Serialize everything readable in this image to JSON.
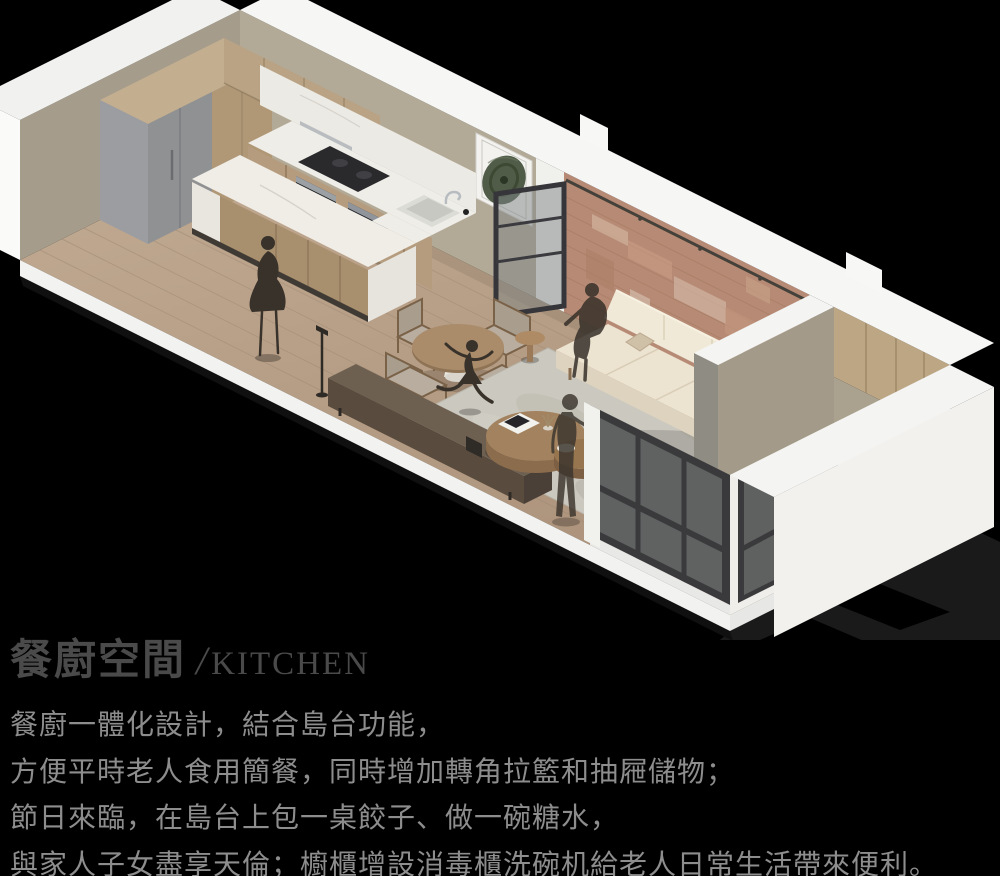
{
  "page": {
    "background_color": "#000000"
  },
  "header": {
    "title_zh": "餐廚空間",
    "title_divider": "/",
    "title_en": "KITCHEN"
  },
  "body": {
    "lines": [
      "餐廚一體化設計，結合島台功能，",
      "方便平時老人食用簡餐，同時增加轉角拉籃和抽屜儲物；",
      "節日來臨，在島台上包一桌餃子、做一碗糖水，",
      "與家人子女盡享天倫；櫥櫃增設消毒櫃洗碗机給老人日常生活帶來便利。"
    ]
  },
  "palette": {
    "background": "#000000",
    "title_text": "#4a4a4a",
    "body_text": "#8d8d8d",
    "white_structure": "#f5f5f3",
    "wall_greige": "#b2a996",
    "wall_side": "#a59c8b",
    "brick_wall": "#b68a74",
    "wood_cabinet": "#b9a384",
    "marble_counter": "#efede7",
    "wood_floor": "#b49c86",
    "sofa_cream": "#ece3d0",
    "rug": "#cbc8bf",
    "window_frame": "#3a3a3c",
    "figure_silhouette": "#38322b",
    "ground_shadow": "#1a1a1a"
  },
  "scene": {
    "label": "axonometric cutaway rendering of an open kitchen, dining and living space with balcony"
  }
}
